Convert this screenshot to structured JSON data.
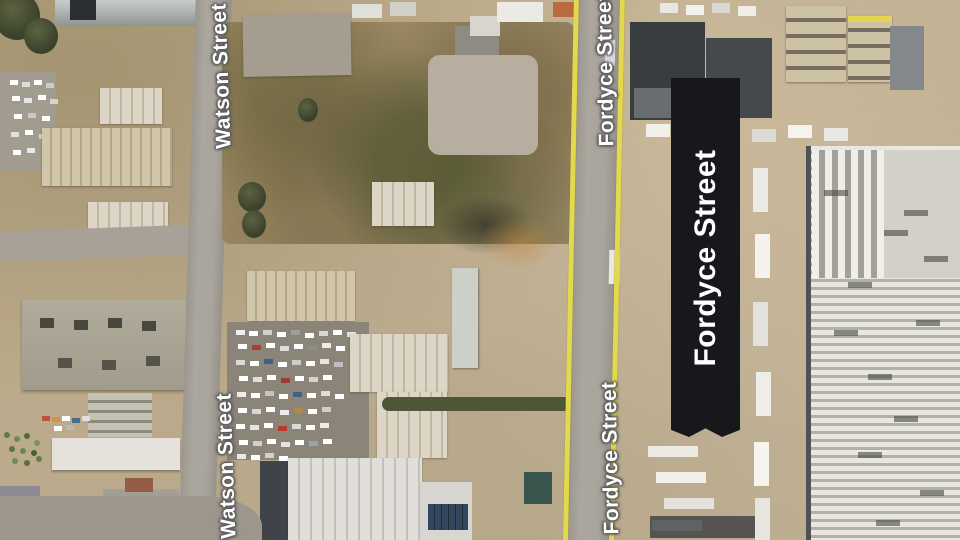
{
  "map": {
    "view": "satellite",
    "streets": {
      "watson_top": {
        "label": "Watson Street"
      },
      "watson_bottom": {
        "label": "Watson Street"
      },
      "fordyce_top": {
        "label": "Fordyce Street"
      },
      "fordyce_bottom": {
        "label": "Fordyce Street"
      }
    },
    "annotation": {
      "label": "Fordyce Street"
    },
    "colors": {
      "road_highlight_yellow": "#e2d94f",
      "annotation_background": "#16181c",
      "annotation_text": "#ffffff",
      "street_label_text": "#ffffff",
      "road_surface": "#a5a19a",
      "ground": "#bcaa8c"
    }
  }
}
